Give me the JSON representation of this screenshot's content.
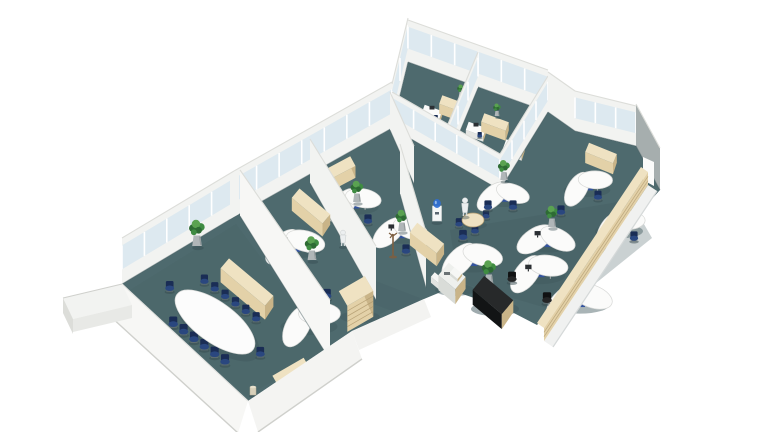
{
  "meta": {
    "description": "3D isometric rendering of an office floor plan with a conference room, private offices, glass-walled offices and an open-plan workspace on teal carpet"
  },
  "palette": {
    "white": "#ffffff",
    "carpet": "#4e6a6e",
    "carpet_dark": "#40585d",
    "floor_line": "#3d5458",
    "wall": "#f2f3f1",
    "wall_bright": "#f7f7f5",
    "wall_mid": "#ebece9",
    "wall_shadow": "#dcddd9",
    "wall_edge": "#cfd0cc",
    "gray_wall": "#a6aeae",
    "glass": "#dde9f0",
    "mullion": "#ffffff",
    "beige_top": "#efe2c2",
    "beige_front": "#e3d1a8",
    "beige_side": "#c9b488",
    "beige_line": "#b09a6e",
    "desk": "#fbfbfa",
    "desk_edge": "#d7d8d6",
    "chair": "#2a477f",
    "chair_dark": "#1a2d55",
    "chair_black": "#242526",
    "chair_black_dark": "#101112",
    "plant_green": "#3f8c42",
    "plant_deep": "#2e6b34",
    "plant_light": "#5aa251",
    "planter": "#b0b6b8",
    "planter_dark": "#8d9496",
    "copier": "#eef0ed",
    "copier_front": "#d9dcd8",
    "copier_side": "#c4c8c4",
    "black_top": "#27292a",
    "black_side": "#121415",
    "monitor": "#2b2f33",
    "pedestal_blue": "#33539e",
    "water_blue": "#2f6fd4",
    "wood": "#7d5f41",
    "mannequin": "#eceff0",
    "shadow_soft": "#e2e6e6"
  },
  "scene": {
    "rooms": [
      {
        "name": "conference-room"
      },
      {
        "name": "private-office-left"
      },
      {
        "name": "private-office-right"
      },
      {
        "name": "glass-office-1"
      },
      {
        "name": "glass-office-2"
      },
      {
        "name": "open-plan-area"
      },
      {
        "name": "copier-corridor"
      }
    ],
    "conference": {
      "table": {
        "cx": 215,
        "cy": 322,
        "rx": 47,
        "ry": 20,
        "rot": 36
      },
      "chairs_per_side": 6,
      "end_chairs": 2
    },
    "desk_clusters": [
      {
        "x": 293,
        "y": 242,
        "s": 0.9,
        "rot": -25,
        "m": 1
      },
      {
        "x": 307,
        "y": 318,
        "s": 0.95,
        "rot": -40
      },
      {
        "x": 352,
        "y": 200,
        "s": 0.82,
        "rot": -30
      },
      {
        "x": 399,
        "y": 229,
        "s": 0.82,
        "rot": -20,
        "m": 1
      },
      {
        "x": 502,
        "y": 193,
        "s": 0.78,
        "rot": -20
      },
      {
        "x": 585,
        "y": 183,
        "s": 0.78,
        "rot": -38
      },
      {
        "x": 546,
        "y": 237,
        "s": 0.86,
        "rot": -12,
        "m": 1
      },
      {
        "x": 617,
        "y": 224,
        "s": 0.8,
        "rot": -40
      },
      {
        "x": 470,
        "y": 256,
        "s": 0.92,
        "rot": -25
      },
      {
        "x": 536,
        "y": 268,
        "s": 0.9,
        "rot": -32,
        "m": 1
      },
      {
        "x": 578,
        "y": 296,
        "s": 0.98,
        "rot": -20
      }
    ],
    "small_desks": [
      {
        "x": 432,
        "y": 112,
        "s": 0.62,
        "rot": 20
      },
      {
        "x": 476,
        "y": 129,
        "s": 0.62,
        "rot": 20
      },
      {
        "x": 514,
        "y": 147,
        "s": 0.66,
        "rot": 20
      }
    ],
    "plants": [
      {
        "x": 197,
        "y": 246,
        "s": 1.05
      },
      {
        "x": 312,
        "y": 260,
        "s": 0.95
      },
      {
        "x": 357,
        "y": 202,
        "s": 0.85
      },
      {
        "x": 402,
        "y": 231,
        "s": 0.85
      },
      {
        "x": 504,
        "y": 180,
        "s": 0.8
      },
      {
        "x": 552,
        "y": 227,
        "s": 0.85
      },
      {
        "x": 489,
        "y": 284,
        "s": 0.95
      },
      {
        "x": 461,
        "y": 97,
        "s": 0.5
      },
      {
        "x": 497,
        "y": 116,
        "s": 0.5
      }
    ],
    "chairs": [
      {
        "x": 278,
        "y": 259,
        "s": 0.85
      },
      {
        "x": 327,
        "y": 297,
        "s": 0.85
      },
      {
        "x": 368,
        "y": 222,
        "s": 0.8
      },
      {
        "x": 406,
        "y": 252,
        "s": 0.8
      },
      {
        "x": 513,
        "y": 208,
        "s": 0.8
      },
      {
        "x": 561,
        "y": 213,
        "s": 0.8
      },
      {
        "x": 598,
        "y": 198,
        "s": 0.78
      },
      {
        "x": 634,
        "y": 239,
        "s": 0.8
      },
      {
        "x": 547,
        "y": 301,
        "s": 0.92,
        "c": "black"
      },
      {
        "x": 463,
        "y": 238,
        "s": 0.85
      },
      {
        "x": 488,
        "y": 208,
        "s": 0.8
      },
      {
        "x": 512,
        "y": 280,
        "s": 0.88,
        "c": "black"
      }
    ],
    "cabinets": [
      {
        "x": 247,
        "y": 282,
        "len": 58,
        "dep": 13,
        "rot": 40,
        "h": 14,
        "name": "conference-credenza"
      },
      {
        "x": 291,
        "y": 372,
        "len": 36,
        "dep": 12,
        "rot": -30,
        "h": 12,
        "name": "low-cabinet"
      },
      {
        "x": 311,
        "y": 206,
        "len": 40,
        "dep": 12,
        "rot": 40,
        "h": 13,
        "name": "low-cabinet"
      },
      {
        "x": 336,
        "y": 170,
        "len": 38,
        "dep": 11,
        "rot": -28,
        "h": 12,
        "name": "window-sill-cabinet"
      },
      {
        "x": 427,
        "y": 238,
        "len": 34,
        "dep": 12,
        "rot": 38,
        "h": 13,
        "name": "low-cabinet"
      },
      {
        "x": 453,
        "y": 104,
        "len": 26,
        "dep": 9,
        "rot": 20,
        "h": 10,
        "name": "low-cabinet"
      },
      {
        "x": 495,
        "y": 122,
        "len": 26,
        "dep": 9,
        "rot": 20,
        "h": 10,
        "name": "low-cabinet"
      },
      {
        "x": 601,
        "y": 153,
        "len": 30,
        "dep": 10,
        "rot": 22,
        "h": 11,
        "name": "low-cabinet"
      }
    ],
    "round_table": {
      "x": 473,
      "y": 220
    },
    "copier": {
      "x": 452,
      "y": 276
    },
    "black_desk": {
      "x": 493,
      "y": 295,
      "rot": 40
    },
    "drawer_chest": {
      "x": 356,
      "y": 291
    },
    "water_cooler": {
      "x": 437,
      "y": 221
    },
    "coat_stand": {
      "x": 393,
      "y": 256
    },
    "mannequins": [
      {
        "x": 343,
        "y": 246,
        "s": 1.0
      },
      {
        "x": 465,
        "y": 216,
        "s": 1.15
      }
    ],
    "waste_bin": {
      "x": 253,
      "y": 393
    },
    "sideboard_row": {
      "x1": 641,
      "y1": 167,
      "x2": 537,
      "y2": 323
    }
  }
}
